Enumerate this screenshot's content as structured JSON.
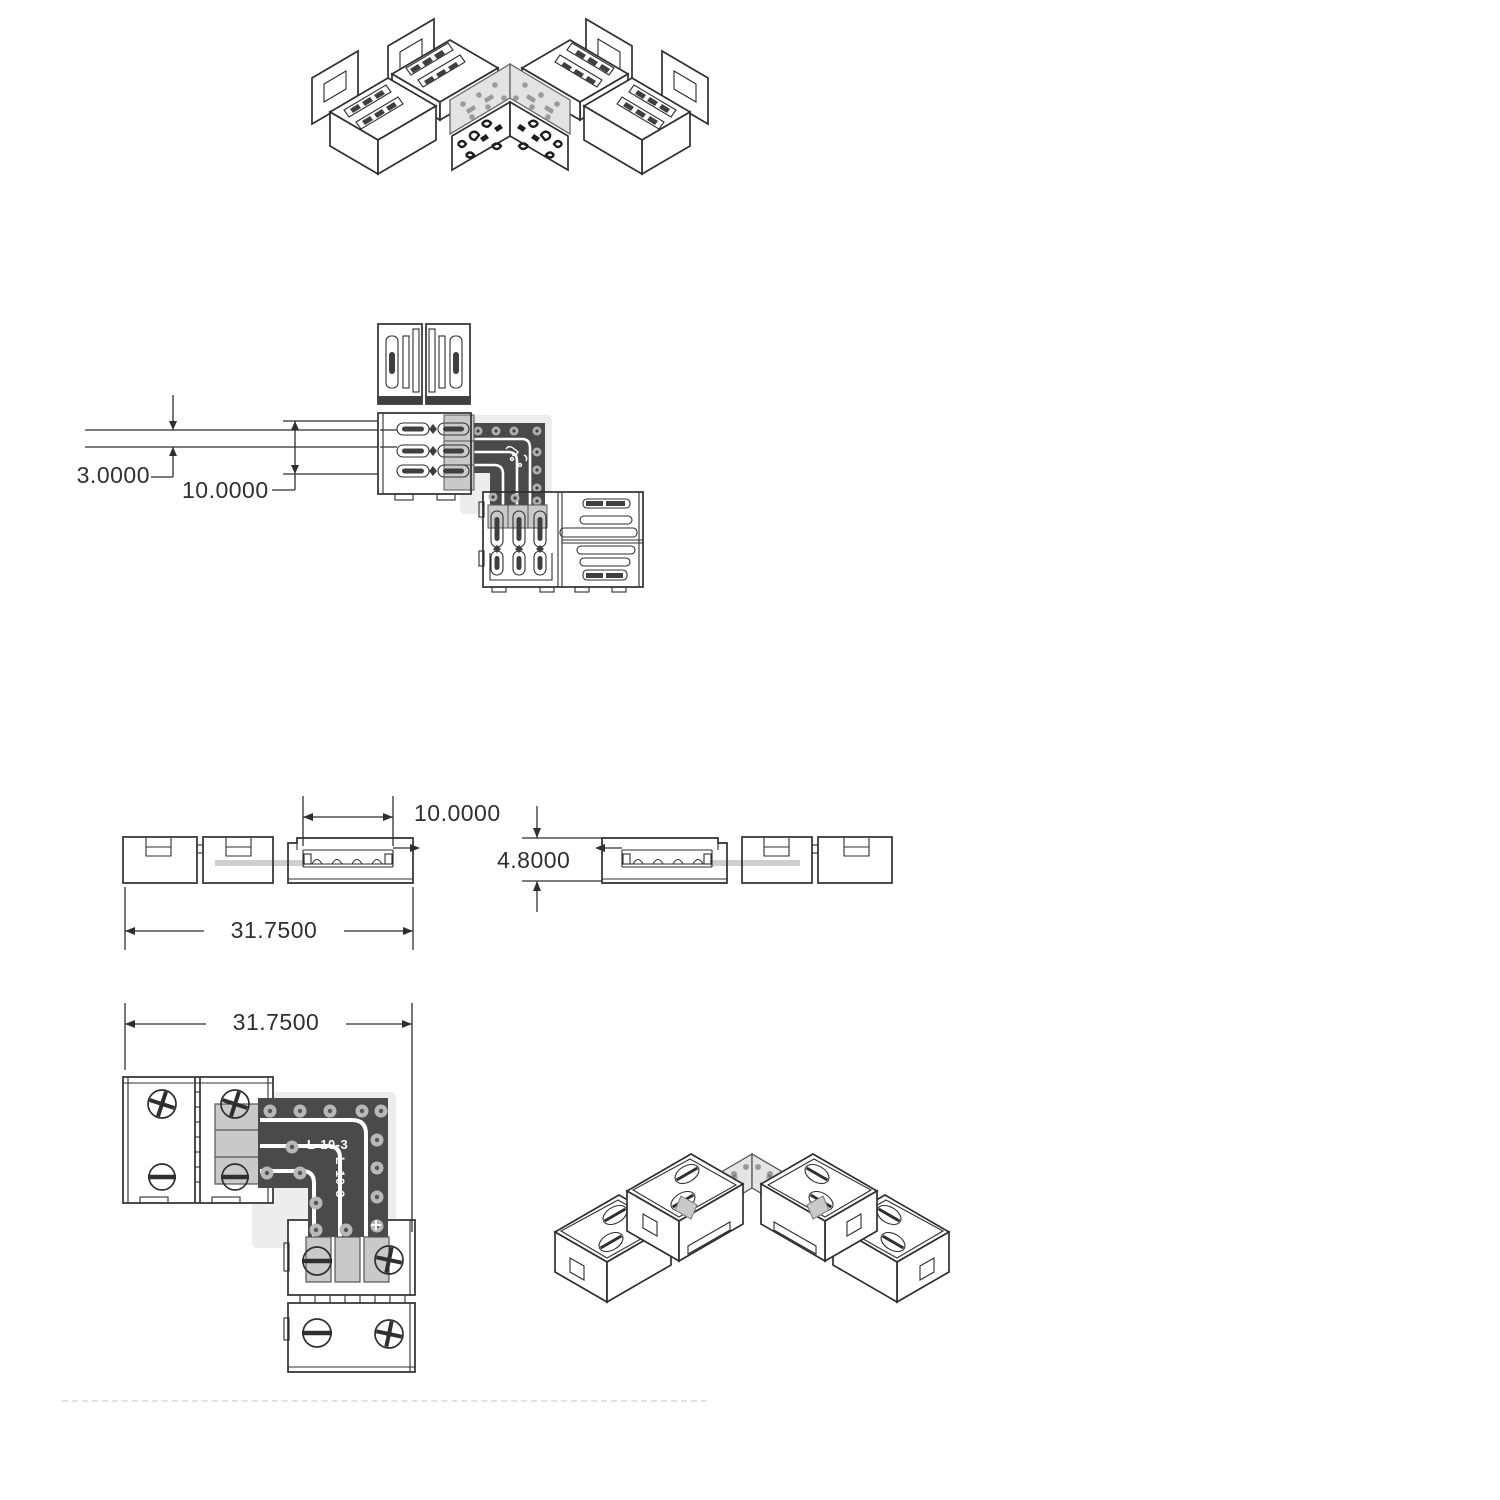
{
  "document": {
    "type": "technical-drawing",
    "background": "#ffffff",
    "subject": "L-shape LED strip corner connector"
  },
  "colors": {
    "line": "#2f2f2f",
    "pcb_body": "#4a4a4a",
    "pcb_pad": "#b8b8b8",
    "contact_pad": "#c9c9c9",
    "ghost_strip": "#cfcfcf",
    "halo": "#ededed",
    "iso_pcb_plate": "#e4e4e4",
    "dim_text": "#2f2f2f"
  },
  "views": {
    "iso_exploded": {
      "name": "exploded-isometric-view"
    },
    "plan_detail": {
      "name": "connection-plan-detail",
      "dim_strip_thickness": "3.0000",
      "dim_strip_width": "10.0000"
    },
    "side_left": {
      "name": "side-elevation-left",
      "dim_opening_width": "10.0000",
      "dim_overall_length": "31.7500"
    },
    "side_right": {
      "name": "side-elevation-right",
      "dim_height": "4.8000"
    },
    "plan_assembled": {
      "name": "assembled-plan-view",
      "dim_overall_length": "31.7500",
      "pcb_marking": "L-10-3",
      "pcb_marking_vertical": "L-10-3"
    },
    "iso_assembled": {
      "name": "assembled-isometric-view"
    }
  }
}
